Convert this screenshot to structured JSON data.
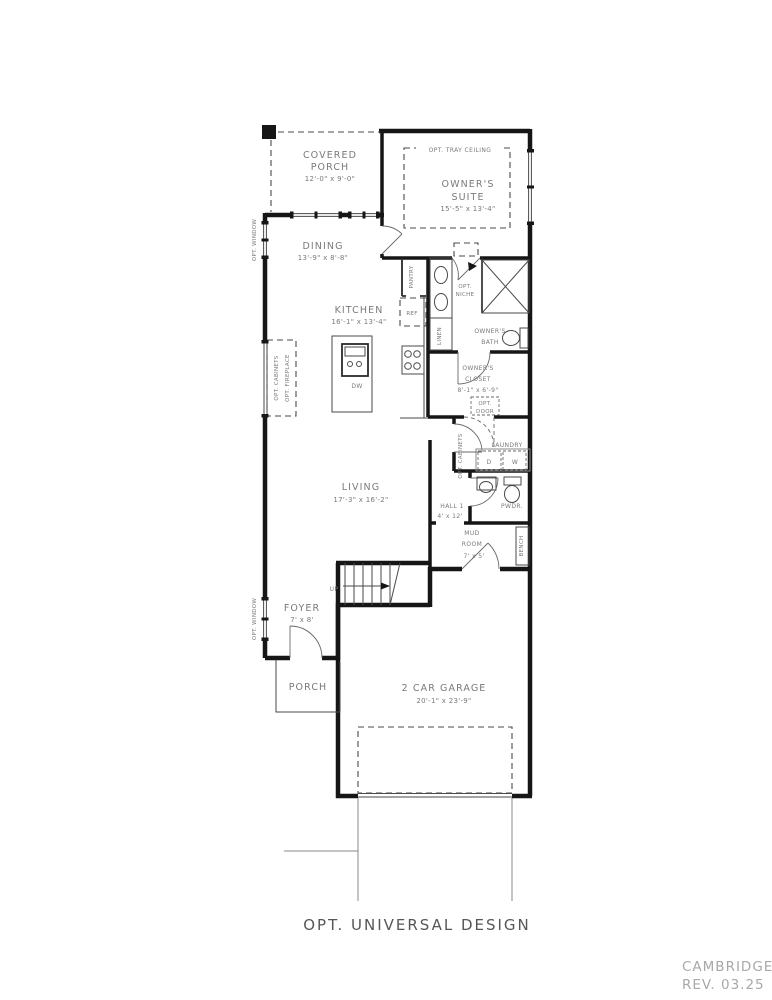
{
  "drawing": {
    "title": "OPT. UNIVERSAL DESIGN",
    "plan_name": "CAMBRIDGE",
    "revision": "REV. 03.25"
  },
  "colors": {
    "wall": "#161616",
    "label": "#7a7a7a",
    "title_text": "#565656",
    "footer_text": "#a8a8a8"
  },
  "rooms": {
    "covered_porch": {
      "l1": "COVERED",
      "l2": "PORCH",
      "dims": "12'-0\" x 9'-0\""
    },
    "owners_suite": {
      "l1": "OWNER'S",
      "l2": "SUITE",
      "dims": "15'-5\" x 13'-4\""
    },
    "dining": {
      "l1": "DINING",
      "dims": "13'-9\" x 8'-8\""
    },
    "kitchen": {
      "l1": "KITCHEN",
      "dims": "16'-1\" x 13'-4\""
    },
    "living": {
      "l1": "LIVING",
      "dims": "17'-3\" x 16'-2\""
    },
    "owners_bath": {
      "l1": "OWNER'S",
      "l2": "BATH"
    },
    "owners_closet": {
      "l1": "OWNER'S",
      "l2": "CLOSET",
      "dims": "8'-1\" x 6'-9\""
    },
    "laundry": {
      "l1": "LAUNDRY"
    },
    "hall": {
      "l1": "HALL 1",
      "dims": "4' x 12'"
    },
    "powder": {
      "l1": "PWDR."
    },
    "mud_room": {
      "l1": "MUD",
      "l2": "ROOM",
      "dims": "7' x 5'"
    },
    "foyer": {
      "l1": "FOYER",
      "dims": "7' x 8'"
    },
    "porch": {
      "l1": "PORCH"
    },
    "garage": {
      "l1": "2 CAR GARAGE",
      "dims": "20'-1\" x 23'-9\""
    },
    "pantry": {
      "l1": "PANTRY"
    }
  },
  "annotations": {
    "opt_tray_ceiling": "OPT. TRAY CEILING",
    "opt_niche_l1": "OPT.",
    "opt_niche_l2": "NICHE",
    "ref": "REF",
    "linen": "LINEN",
    "dw": "DW",
    "dryer": "D",
    "washer": "W",
    "up": "UP",
    "opt_door_l1": "OPT.",
    "opt_door_l2": "DOOR",
    "opt_window_1": "OPT. WINDOW",
    "opt_window_2": "OPT. WINDOW",
    "opt_cabinets": "OPT. CABINETS",
    "opt_fireplace": "OPT. FIREPLACE",
    "laundry_cabinets": "OPT. CABINETS",
    "bench": "BENCH"
  }
}
